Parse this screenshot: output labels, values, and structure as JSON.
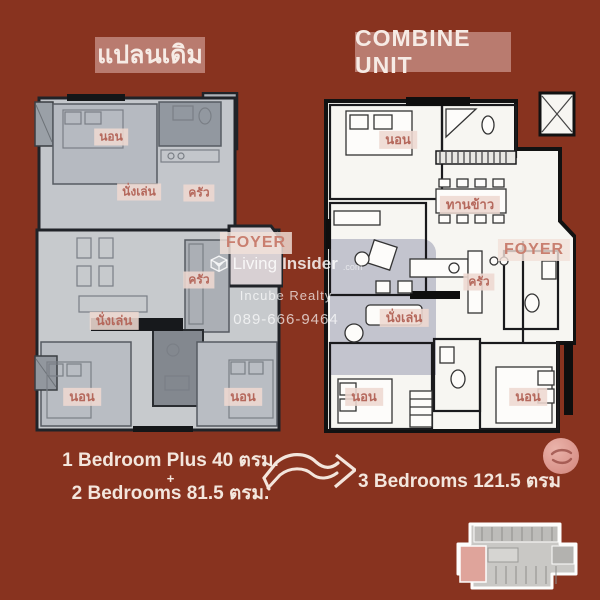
{
  "header": {
    "left_title": "แปลนเดิม",
    "right_title": "COMBINE UNIT",
    "badge_color": "#b97b6f",
    "background_color": "#88331f"
  },
  "left_plan": {
    "description": "original two-unit greyed floor plan",
    "labels": {
      "bedroom_top": "นอน",
      "living_top": "นั่งเล่น",
      "kitchen_top": "ครัว",
      "foyer": "FOYER",
      "kitchen_bottom": "ครัว",
      "living_bottom": "นั่งเล่น",
      "bedroom_bottom_left": "นอน",
      "bedroom_bottom_right": "นอน"
    }
  },
  "right_plan": {
    "description": "combined 3-bedroom white floor plan",
    "labels": {
      "bedroom_top": "นอน",
      "dining": "ทานข้าว",
      "foyer": "FOYER",
      "kitchen": "ครัว",
      "living": "นั่งเล่น",
      "bedroom_bottom_left": "นอน",
      "bedroom_bottom_right": "นอน"
    }
  },
  "watermark": {
    "brand_light": "Living",
    "brand_bold": "Insider",
    "brand_suffix": ".com",
    "company": "Incube Realty",
    "phone": "089-666-9464"
  },
  "summary": {
    "before_line1": "1 Bedroom Plus 40 ตรม.",
    "plus": "+",
    "before_line2": "2 Bedrooms 81.5 ตรม.",
    "after": "3 Bedrooms 121.5 ตรม"
  },
  "icons": {
    "arrow": "combine-direction-arrow",
    "sticker": "brand-sticker",
    "keyplan": "building-key-plan",
    "logo_cube": "living-insider-cube-logo"
  },
  "colors": {
    "background": "#88331f",
    "badge": "#b97b6f",
    "label_text": "#b5685c",
    "label_chip": "#eed8d0",
    "plan_grey": "#c4c7cb",
    "plan_white": "#f7f6f2",
    "wall": "#141618",
    "highlight_lavender": "#8f91a9",
    "text_cream": "#f3e6dd"
  }
}
